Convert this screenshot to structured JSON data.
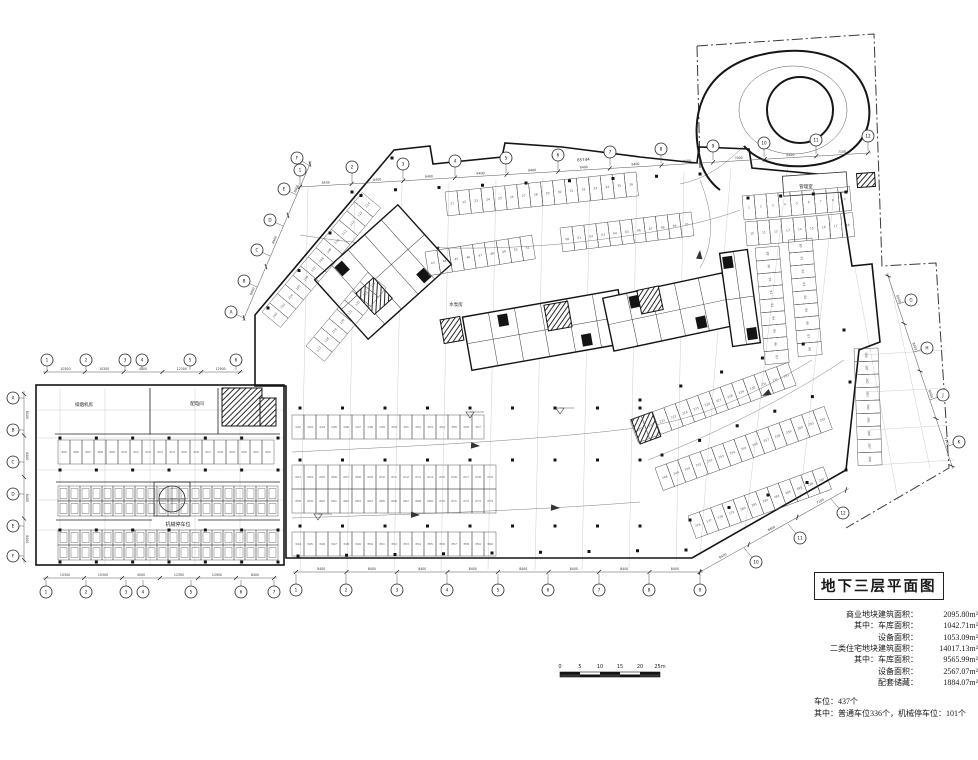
{
  "title_block": {
    "title": "地下三层平面图",
    "stats": [
      {
        "indent": 0,
        "label": "商业地块建筑面积：",
        "value": "2095.80m²"
      },
      {
        "indent": 1,
        "label": "其中：车库面积：",
        "value": "1042.71m²"
      },
      {
        "indent": 2,
        "label": "设备面积：",
        "value": "1053.09m²"
      },
      {
        "indent": 0,
        "label": "二类住宅地块建筑面积：",
        "value": "14017.13m²"
      },
      {
        "indent": 1,
        "label": "其中：车库面积：",
        "value": "9565.99m²"
      },
      {
        "indent": 2,
        "label": "设备面积：",
        "value": "2567.07m²"
      },
      {
        "indent": 2,
        "label": "配套储藏：",
        "value": "1884.07m²"
      }
    ],
    "parking_total": "车位：437个",
    "parking_detail": "其中：普通车位336个，机械停车位：101个"
  },
  "scale_bar": {
    "labels": [
      "0",
      "5",
      "10",
      "15",
      "20",
      "25m"
    ]
  },
  "plan": {
    "outline": "M 255,315 L 394,150 L 430,146 L 433,164 L 502,157 L 505,143 L 562,147 L 640,157 L 697,163 L 699,147 L 749,149 L 752,168 L 838,176 L 852,266 L 872,264 L 880,342 L 859,350 L 846,470 L 692,558 L 286,558 L 286,386 L 255,386 Z",
    "block": [
      36,
      385,
      248,
      180
    ],
    "boundary": [
      "M 697,46 L 874,34 L 882,266 L 936,263 L 949,468 L 846,528",
      "M 697,46 L 700,168"
    ],
    "grid": [
      [
        308,
        188,
        300,
        570
      ],
      [
        355,
        186,
        347,
        570
      ],
      [
        402,
        184,
        394,
        570
      ],
      [
        449,
        182,
        441,
        570
      ],
      [
        496,
        180,
        488,
        570
      ],
      [
        543,
        178,
        535,
        570
      ],
      [
        590,
        176,
        582,
        570
      ],
      [
        637,
        174,
        629,
        568
      ],
      [
        684,
        172,
        676,
        562
      ],
      [
        731,
        168,
        700,
        556
      ],
      [
        788,
        164,
        745,
        530
      ],
      [
        836,
        176,
        800,
        500
      ],
      [
        855,
        268,
        898,
        500
      ],
      [
        888,
        272,
        930,
        468
      ],
      [
        38,
        410,
        284,
        410
      ],
      [
        38,
        438,
        284,
        438
      ],
      [
        38,
        470,
        284,
        470
      ],
      [
        38,
        500,
        284,
        500
      ],
      [
        38,
        530,
        284,
        530
      ],
      [
        60,
        388,
        60,
        565
      ],
      [
        105,
        388,
        105,
        565
      ],
      [
        150,
        388,
        150,
        565
      ],
      [
        195,
        388,
        195,
        565
      ],
      [
        240,
        388,
        240,
        565
      ],
      [
        862,
        355,
        945,
        350
      ],
      [
        866,
        392,
        950,
        388
      ],
      [
        870,
        430,
        952,
        425
      ],
      [
        874,
        465,
        955,
        460
      ]
    ],
    "walls": [
      [
        55,
        434,
        280,
        434
      ],
      [
        150,
        388,
        150,
        434
      ],
      [
        218,
        388,
        218,
        434
      ],
      [
        56,
        482,
        280,
        482
      ],
      [
        56,
        520,
        152,
        520
      ],
      [
        198,
        520,
        280,
        520
      ]
    ],
    "towers": [
      {
        "x": 383,
        "y": 272,
        "w": 112,
        "h": 80,
        "a": -42,
        "p": 4
      },
      {
        "x": 545,
        "y": 330,
        "w": 158,
        "h": 54,
        "a": -10,
        "p": 5
      },
      {
        "x": 668,
        "y": 312,
        "w": 122,
        "h": 54,
        "a": -12,
        "p": 4
      },
      {
        "x": 740,
        "y": 298,
        "w": 28,
        "h": 94,
        "a": -8,
        "p": 1
      }
    ],
    "cores": [
      {
        "x": 374,
        "y": 296,
        "w": 24,
        "h": 28,
        "a": -42
      },
      {
        "x": 452,
        "y": 330,
        "w": 20,
        "h": 24,
        "a": -10
      },
      {
        "x": 558,
        "y": 316,
        "w": 24,
        "h": 26,
        "a": -10
      },
      {
        "x": 650,
        "y": 300,
        "w": 22,
        "h": 24,
        "a": -12
      },
      {
        "x": 646,
        "y": 428,
        "w": 22,
        "h": 26,
        "a": -20
      },
      {
        "x": 242,
        "y": 407,
        "w": 40,
        "h": 38,
        "a": 0
      },
      {
        "x": 268,
        "y": 412,
        "w": 16,
        "h": 28,
        "a": 0
      },
      {
        "x": 866,
        "y": 180,
        "w": 18,
        "h": 14,
        "a": -4
      }
    ],
    "rooms": [
      {
        "x": 815,
        "y": 184,
        "w": 64,
        "h": 20,
        "a": -4
      }
    ],
    "tank": {
      "cx": 172,
      "cy": 499,
      "r": 13,
      "bx": 154,
      "by": 482,
      "bw": 36,
      "bh": 34
    },
    "rows": [
      {
        "x": 58,
        "y": 440,
        "a": 0,
        "n": 18,
        "s": 305
      },
      {
        "x": 292,
        "y": 415,
        "a": 0,
        "n": 16,
        "s": 142
      },
      {
        "x": 292,
        "y": 465,
        "a": 0,
        "n": 17,
        "s": 203,
        "s2": 258
      },
      {
        "x": 292,
        "y": 532,
        "a": 0,
        "n": 17,
        "s": 344
      },
      {
        "x": 262,
        "y": 312,
        "a": -50,
        "n": 13,
        "s": 102
      },
      {
        "x": 306,
        "y": 346,
        "a": -50,
        "n": 8,
        "s": 117
      },
      {
        "x": 445,
        "y": 192,
        "a": -6,
        "n": 16,
        "s": 21
      },
      {
        "x": 560,
        "y": 228,
        "a": -7,
        "n": 11,
        "s": 60
      },
      {
        "x": 425,
        "y": 252,
        "a": -9,
        "n": 9,
        "s": 43
      },
      {
        "x": 630,
        "y": 420,
        "a": -20,
        "n": 14,
        "s": 220
      },
      {
        "x": 655,
        "y": 468,
        "a": -20,
        "n": 15,
        "s": 248
      },
      {
        "x": 688,
        "y": 516,
        "a": -20,
        "n": 12,
        "s": 276
      },
      {
        "x": 742,
        "y": 196,
        "a": -5,
        "n": 9,
        "s": 1
      },
      {
        "x": 745,
        "y": 222,
        "a": -5,
        "n": 9,
        "s": 10
      },
      {
        "x": 812,
        "y": 238,
        "a": 85,
        "n": 9,
        "s": 80,
        "w": 13
      },
      {
        "x": 779,
        "y": 246,
        "a": 85,
        "n": 9,
        "s": 89,
        "w": 13
      },
      {
        "x": 878,
        "y": 348,
        "a": 88,
        "n": 9,
        "s": 380,
        "w": 13
      }
    ],
    "mech": [
      {
        "x": 58,
        "y": 486,
        "n": 20
      },
      {
        "x": 58,
        "y": 501,
        "n": 20
      },
      {
        "x": 58,
        "y": 530,
        "n": 20
      },
      {
        "x": 58,
        "y": 545,
        "n": 20
      }
    ],
    "columns": [
      [
        300,
        408,
        640,
        408,
        9
      ],
      [
        300,
        460,
        640,
        460,
        9
      ],
      [
        300,
        526,
        640,
        526,
        9
      ],
      [
        298,
        556,
        686,
        550,
        9
      ],
      [
        640,
        400,
        844,
        330,
        6
      ],
      [
        662,
        455,
        850,
        382,
        6
      ],
      [
        690,
        520,
        846,
        470,
        5
      ],
      [
        352,
        192,
        700,
        174,
        9
      ],
      [
        268,
        308,
        392,
        158,
        5
      ],
      [
        748,
        198,
        846,
        192,
        4
      ],
      [
        60,
        438,
        278,
        438,
        7
      ],
      [
        60,
        470,
        278,
        470,
        7
      ],
      [
        60,
        530,
        278,
        530,
        7
      ],
      [
        60,
        562,
        278,
        562,
        7
      ]
    ],
    "lanes": [
      "M 292,452 C 420,446 540,440 636,428 C 700,420 760,392 812,360",
      "M 292,518 C 420,514 540,510 640,502",
      "M 300,235 C 380,248 470,252 560,244 C 640,236 700,225 740,210",
      "M 648,460 C 720,432 790,396 844,360",
      "M 700,180 C 712,210 716,240 700,268",
      "M 744,146 C 720,170 700,180 680,184"
    ],
    "arrows": [
      [
        480,
        446,
        184
      ],
      [
        420,
        515,
        182
      ],
      [
        430,
        249,
        4
      ],
      [
        762,
        396,
        -27
      ],
      [
        560,
        508,
        183
      ],
      [
        700,
        250,
        95
      ]
    ],
    "spiral": {
      "outer": "M 702,166 C 688,118 700,72 756,56 C 818,40 864,62 869,106 C 873,142 844,163 806,166 C 778,168 756,160 744,146",
      "inner": {
        "cx": 800,
        "cy": 110,
        "r": 33
      },
      "mid": {
        "cx": 793,
        "cy": 110,
        "rx": 54,
        "ry": 44
      },
      "tail": "M 702,166 C 706,176 712,184 720,190"
    },
    "dims": [
      {
        "p": [
          300,
          187,
          868,
          153
        ],
        "segs": [
          "8400",
          "8400",
          "8400",
          "8400",
          "8400",
          "8400",
          "8400",
          "8400",
          "7000",
          "8400",
          "7100"
        ],
        "overall": "85744"
      },
      {
        "p": [
          296,
          572,
          700,
          572
        ],
        "segs": [
          "8400",
          "8400",
          "8400",
          "8400",
          "8400",
          "8400",
          "8400",
          "8400"
        ]
      },
      {
        "p": [
          700,
          572,
          846,
          490
        ],
        "segs": [
          "8400",
          "8400",
          "7100"
        ]
      },
      {
        "p": [
          888,
          276,
          952,
          466
        ],
        "segs": [
          "8400",
          "8400",
          "8400",
          "7100"
        ]
      },
      {
        "p": [
          46,
          372,
          240,
          372
        ],
        "segs": [
          "10300",
          "10300",
          "4500",
          "12300",
          "12900"
        ],
        "overall": "54327"
      },
      {
        "p": [
          46,
          578,
          274,
          578
        ],
        "segs": [
          "10300",
          "10300",
          "4500",
          "12300",
          "12900",
          "8400"
        ]
      },
      {
        "p": [
          24,
          394,
          24,
          560
        ],
        "segs": [
          "8400",
          "6400",
          "8400",
          "8400"
        ]
      },
      {
        "p": [
          244,
          318,
          310,
          164
        ],
        "segs": [
          "8400",
          "8400",
          "8400"
        ]
      }
    ],
    "bubbles": [
      [
        300,
        170,
        "1",
        [
          300,
          185
        ]
      ],
      [
        352,
        167,
        "2",
        [
          352,
          182
        ]
      ],
      [
        403,
        164,
        "3",
        [
          403,
          179
        ]
      ],
      [
        455,
        161,
        "4",
        [
          455,
          176
        ]
      ],
      [
        506,
        158,
        "5",
        [
          506,
          173
        ]
      ],
      [
        558,
        155,
        "6",
        [
          558,
          170
        ]
      ],
      [
        610,
        152,
        "7",
        [
          610,
          166
        ]
      ],
      [
        661,
        149,
        "8",
        [
          661,
          163
        ]
      ],
      [
        713,
        146,
        "9",
        [
          713,
          160
        ]
      ],
      [
        764,
        143,
        "10",
        [
          764,
          157
        ]
      ],
      [
        816,
        140,
        "11",
        [
          816,
          154
        ]
      ],
      [
        868,
        136,
        "12",
        [
          868,
          151
        ]
      ],
      [
        231,
        312,
        "A",
        [
          244,
          318
        ]
      ],
      [
        244,
        281,
        "B",
        [
          257,
          287
        ]
      ],
      [
        257,
        250,
        "C",
        [
          270,
          256
        ]
      ],
      [
        270,
        220,
        "D",
        [
          283,
          226
        ]
      ],
      [
        284,
        189,
        "E",
        [
          297,
          195
        ]
      ],
      [
        297,
        158,
        "F",
        [
          310,
          166
        ]
      ],
      [
        911,
        300,
        "G",
        [
          898,
          304
        ]
      ],
      [
        927,
        348,
        "H",
        [
          914,
          352
        ]
      ],
      [
        943,
        395,
        "J",
        [
          930,
          400
        ]
      ],
      [
        959,
        442,
        "K",
        [
          946,
          447
        ]
      ],
      [
        296,
        590,
        "1",
        [
          296,
          574
        ]
      ],
      [
        346,
        590,
        "2",
        [
          346,
          574
        ]
      ],
      [
        397,
        590,
        "3",
        [
          397,
          574
        ]
      ],
      [
        447,
        590,
        "4",
        [
          447,
          574
        ]
      ],
      [
        498,
        590,
        "5",
        [
          498,
          574
        ]
      ],
      [
        548,
        590,
        "6",
        [
          548,
          574
        ]
      ],
      [
        599,
        590,
        "7",
        [
          599,
          574
        ]
      ],
      [
        649,
        590,
        "8",
        [
          649,
          574
        ]
      ],
      [
        700,
        590,
        "9",
        [
          700,
          574
        ]
      ],
      [
        756,
        562,
        "10",
        [
          744,
          548
        ]
      ],
      [
        800,
        538,
        "11",
        [
          788,
          524
        ]
      ],
      [
        843,
        513,
        "12",
        [
          831,
          499
        ]
      ],
      [
        47,
        360,
        "1",
        [
          47,
          370
        ]
      ],
      [
        86,
        360,
        "2",
        [
          86,
          370
        ]
      ],
      [
        125,
        360,
        "3",
        [
          125,
          370
        ]
      ],
      [
        142,
        360,
        "4",
        [
          142,
          370
        ]
      ],
      [
        190,
        360,
        "5",
        [
          190,
          370
        ]
      ],
      [
        236,
        360,
        "6",
        [
          236,
          370
        ]
      ],
      [
        46,
        592,
        "1",
        [
          46,
          580
        ]
      ],
      [
        86,
        592,
        "2",
        [
          86,
          580
        ]
      ],
      [
        126,
        592,
        "3",
        [
          126,
          580
        ]
      ],
      [
        143,
        592,
        "4",
        [
          143,
          580
        ]
      ],
      [
        191,
        592,
        "5",
        [
          191,
          580
        ]
      ],
      [
        241,
        592,
        "6",
        [
          241,
          580
        ]
      ],
      [
        274,
        592,
        "7",
        [
          274,
          580
        ]
      ],
      [
        13,
        398,
        "A",
        [
          24,
          398
        ]
      ],
      [
        13,
        430,
        "B",
        [
          24,
          430
        ]
      ],
      [
        13,
        462,
        "C",
        [
          24,
          462
        ]
      ],
      [
        13,
        494,
        "D",
        [
          24,
          494
        ]
      ],
      [
        13,
        526,
        "E",
        [
          24,
          526
        ]
      ],
      [
        13,
        556,
        "F",
        [
          24,
          556
        ]
      ]
    ],
    "labels": [
      {
        "t": "排烟机房",
        "x": 84,
        "y": 406,
        "s": 4.5
      },
      {
        "t": "配电间",
        "x": 197,
        "y": 405,
        "s": 4.5
      },
      {
        "t": "机械停车位",
        "x": 178,
        "y": 526,
        "s": 5
      },
      {
        "t": "水泵房",
        "x": 456,
        "y": 306,
        "s": 4.5
      },
      {
        "t": "管理室",
        "x": 806,
        "y": 188,
        "s": 4.5
      }
    ],
    "flags": [
      [
        318,
        520
      ],
      [
        470,
        418
      ],
      [
        560,
        414
      ]
    ]
  }
}
